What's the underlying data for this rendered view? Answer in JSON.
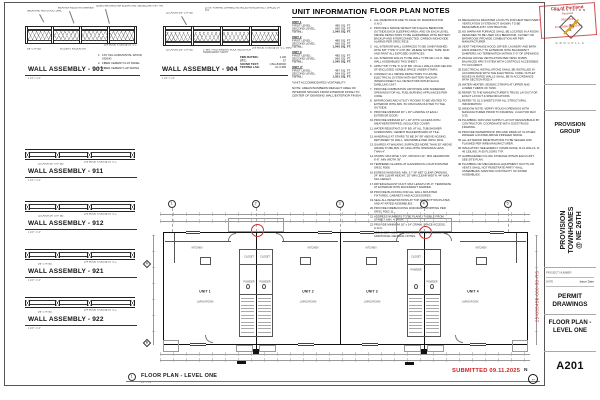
{
  "sheet": {
    "submitted_stamp": "SUBMITTED 09.11.2025",
    "permit_number_vertical": "25-035456-000-00-RS",
    "north_label": "N",
    "north_arrow": "←",
    "view_title": {
      "number": "1",
      "title": "FLOOR PLAN - LEVEL ONE",
      "scale": "1/4\" = 1'-0\""
    }
  },
  "title_block": {
    "logo_brand": "P R O V I S I O N",
    "logo_letter": "P",
    "logo_sub": "G R O U P  L L C",
    "stamp": {
      "city": "City of Portland",
      "line2": "Received",
      "line3": "09/11/2025",
      "line4": "25-035456-000-00-RS"
    },
    "firm_name": "PROVISION GROUP",
    "project_name_line1": "PROVISION TOWNHOMES",
    "project_name_line2": "@ NE 26TH",
    "fields": [
      {
        "label": "PROJECT NUMBER",
        "value": "2025001"
      },
      {
        "label": "DATE",
        "value": "Issue Date"
      }
    ],
    "phase": "PERMIT DRAWINGS",
    "sheet_title_line1": "FLOOR PLAN -",
    "sheet_title_line2": "LEVEL ONE",
    "sheet_number": "A201"
  },
  "wall_assemblies": [
    {
      "title": "WALL ASSEMBLY - 901",
      "scale": "1 1/2\" = 1'-0\"",
      "callout_top_1": "SHEATHING PER STRUCTURAL",
      "callout_top_2": "WEATHER RESISTANT BARRIER",
      "callout_top_3": "SIDING MATERIAL PER ELEVATIONS, SEE BELOW FOR TYPE",
      "callout_bot_1": "5/8\" GYP. BD.",
      "callout_bot_2": "R-21 BATT INSULATION",
      "callout_bot_3": "2X6 WOOD STUDS @ 16\" O.C.",
      "siding_types": [
        "1X6 T&G HORIZONTAL WOOD SIDING",
        "FIBER CEMENT FLAT PANEL",
        "FIBER CEMENT LAP SIDING"
      ]
    },
    {
      "title": "WALL ASSEMBLY - 904",
      "scale": "1 1/2\" = 1'-0\"",
      "callout_top_1": "(2) LAYERS 5/8\" GYP. BD.",
      "callout_top_2": "25 GA. FURRING CHANNEL INSTALLED HORIZONTALLY, SPACED 24\" O.C.",
      "callout_bot_1": "(2) LAYERS 5/8\" GYP. BD.",
      "callout_bot_2": "3\" MIN. THICK MINERAL WOOL INSULATION THROUGHOUT CAVITY",
      "callout_bot_3": "2X6 WOOD STUDS @ 16\" O.C. (MIN)",
      "ratings": [
        {
          "label": "FIRE RATING:",
          "value": "1 HR"
        },
        {
          "label": "STC:",
          "value": "57"
        },
        {
          "label": "SOUND TEST:",
          "value": "USG-840630"
        },
        {
          "label": "TESTING LAB:",
          "value": "UL U305"
        }
      ]
    },
    {
      "title": "WALL ASSEMBLY - 911",
      "scale": "1 1/2\" = 1'-0\"",
      "callout_bot_1": "(1) LAYER 5/8\" GYP. BD.",
      "callout_bot_2": "2X6 WOOD STUDS @ 16\" O.C."
    },
    {
      "title": "WALL ASSEMBLY - 912",
      "scale": "1 1/2\" = 1'-0\"",
      "callout_bot_1": "(1) LAYER 5/8\" GYP. BD.",
      "callout_bot_2": "2X6 WOOD STUDS @ 16\" O.C."
    },
    {
      "title": "WALL ASSEMBLY - 921",
      "scale": "1 1/2\" = 1'-0\"",
      "callout_bot_1": "5/8\" GYP. BD.",
      "callout_bot_2": "2X4 WOOD STUDS @ 16\" O.C."
    },
    {
      "title": "WALL ASSEMBLY - 922",
      "scale": "1 1/2\" = 1'-0\"",
      "callout_bot_1": "5/8\" GYP. BD.",
      "callout_bot_2": "2X4 WOOD STUDS @ 16\" O.C."
    }
  ],
  "unit_information": {
    "heading": "UNIT INFORMATION",
    "row_labels": {
      "first": "FIRST LEVEL:",
      "second": "SECOND LEVEL:",
      "total": "TOTAL:"
    },
    "units": [
      {
        "name": "UNIT 1",
        "first": "485 SQ. FT.",
        "second": "560 SQ. FT.",
        "total": "1,045 SQ. FT."
      },
      {
        "name": "UNIT 2",
        "first": "485 SQ. FT.",
        "second": "560 SQ. FT.",
        "total": "1,045 SQ. FT."
      },
      {
        "name": "UNIT 3",
        "first": "485 SQ. FT.",
        "second": "560 SQ. FT.",
        "total": "1,045 SQ. FT."
      },
      {
        "name": "UNIT 4*",
        "first": "487 SQ. FT.",
        "second": "564 SQ. FT.",
        "total": "1,051 SQ. FT."
      }
    ],
    "footnote": "*UNIT ACCOMMODATES VISITABILITY",
    "note": "NOTE: AREAS/NUMBERS REFLECT AREA OF INTERIOR SPACES FROM INTERIOR FINISH TO CENTER OF DEMISING WALL/EXTERIOR FINISH."
  },
  "floor_plan_notes": {
    "heading": "FLOOR PLAN NOTES",
    "notes_col1": [
      "ALL DIMENSIONS ARE TO FACE OF FRAMING/STUD U.N.O.",
      "PROVIDE A SMOKE DETECTOR IN EACH BEDROOM, OUTSIDE EACH SLEEPING AREA, AND ON EACH LEVEL. SMOKE DETECTORS TO BE HARDWIRED WITH BATTERY BACKUP AND INTERCONNECTED. CARBON MONOXIDE ALARMS PER ORSC R315.",
      "ALL INTERIOR WALL SURFACES TO BE GWB FINISHED WITH 5/8\" TYPE 'X' GYP. BD. WHERE NOTED. TAPE, MUD AND PAINT ALL EXPOSED SURFACES.",
      "ALL INTERIOR WALLS TO BE WALL TYPE 911 U.N.O. SEE WALL ASSEMBLIES THIS SHEET.",
      "APPLY 5/8\" TYPE 'X' GYP. BD. ON ALL WALLS AND CEILING OF ENCLOSED USABLE SPACE UNDER STAIRS.",
      "CONNECT ALL SMOKE DETECTORS TO HOUSE ELECTRICAL SYSTEM WITH BATTERY BACKUP; INTERCONNECT ALL DETECTORS WITHIN EACH DWELLING UNIT.",
      "PROVIDE COMBUSTION AIR INTAKE AND SCREENED OPENINGS FOR ALL FUEL BURNING APPLIANCES PER CODE.",
      "BATHROOMS AND UTILITY ROOMS TO BE VENTED TO EXTERIOR WITH MIN. 50 CFM FANS DUCTED TO THE OUTSIDE.",
      "PROVIDE MINIMUM 36\" x 36\" LANDING AT EACH EXTERIOR DOOR.",
      "PROVIDE MINIMUM 22\" x 30\" ATTIC ACCESS WITH WEATHERSTRIPPED, INSULATED COVER.",
      "WATER RESISTANT GYP. BD. AT ALL TUB/SHOWER SURROUNDS; CEMENT BACKER BOARD AT TILE.",
      "HANDRAILS AT STAIRS TO BE 34\"-38\" ABOVE NOSING, RETURNED TO WALL, GRASPABLE PER ORSC R311.",
      "GUARDS AT WALKING SURFACES MORE THAN 30\" ABOVE GRADE TO BE MIN. 36\" HIGH WITH OPENINGS LESS THAN 4\".",
      "STAIRS: MAX RISE 7-3/4\", MIN RUN 10\", MIN HEADROOM 6'-8\", MIN WIDTH 36\".",
      "TEMPERED GLAZING AT HAZARDOUS LOCATIONS PER ORSC R308.",
      "EGRESS WINDOWS: MIN. 5.7 SF NET CLEAR OPENING, 24\" MIN CLEAR HEIGHT, 20\" MIN CLEAR WIDTH, 44\" MAX SILL HEIGHT.",
      "DRYER EXHAUST DUCT: MAX LENGTH 35'-0\"; TERMINATE AT EXTERIOR WITH BACKDRAFT DAMPER.",
      "PROVIDE BLOCKING FOR ALL WALL MOUNTED FIXTURES, CABINETS AND ACCESSORIES.",
      "SEAL ALL PENETRATIONS AT TOP AND BOTTOM PLATES AND AT RATED ASSEMBLIES.",
      "PROVIDE FIREBLOCKING AND DRAFTSTOPPING PER ORSC R302.11.",
      "ADDRESS NUMBERS TO BE PLAINLY VISIBLE FROM STREET, MIN. 4\" HIGH.",
      "PROVIDE MINIMUM 18\" x 24\" CRAWL SPACE ACCESS, U.N.O.",
      "SEE SHEET A001 FOR ABBREVIATIONS, SYMBOLS AND ADDITIONAL GENERAL NOTES."
    ],
    "notes_col2": [
      "MECHANICAL REGISTER LAYOUTS FOR HEAT RECOVERY VENTILATION SYSTEM NOT SHOWN; TO BE DESIGN/BUILD BY CONTRACTOR.",
      "NO WARM AIR FURNACE SHALL BE LOCATED IN A ROOM DESIGNED TO BE USED AS A BEDROOM, CLOSET OR BATHROOM; PROVIDE COMBUSTION AIR PER MANUFACTURER.",
      "VENT THE RANGE HOOD, DRYER, LAUNDRY AND BATH FANS DIRECTLY TO EXTERIOR WITH BACKDRAFT DAMPERS; NO TERMINATION WITHIN 3'-0\" OF OPENINGS.",
      "WHOLE HOUSE VENTILATION PER ORSC M1505; BALANCED HRV SYSTEM WITH CONTROLS ACCESSIBLE TO OCCUPANT.",
      "ELECTRICAL INSTALLATIONS SHALL BE INSTALLED IN ACCORDANCE WITH THE ELECTRICAL CODE; OUTLET BOXES IN RATED WALLS SHALL BE IN ACCORDANCE WITH SECTION R302.4.",
      "WATER HEATER: SEISMIC STRAPS AT UPPER AND LOWER THIRDS OF TANK.",
      "REFER TO THE MANUFACTURER'S TRUSS LAYOUT FOR EXACT LAYOUT & SPECIFICATIONS.",
      "REFER TO S1.0 SHEETS FOR ALL STRUCTURAL INFORMATION.",
      "WINDOW NOTE: VERIFY ROUGH OPENINGS WITH MANUFACTURER PRIOR TO FRAMING; U-FACTOR MAX 0.30.",
      "PLUMBING: DWV AND SUPPLY LAYOUT DESIGN/BUILD BY CONTRACTOR; COORDINATE WITH JOIST/TRUSS FRAMING.",
      "PROVIDE WATERPROOF PAN AND DRAIN AT CLOTHES WASHER LOCATED ABOVE FINISHED SPACE.",
      "ALL EXTERIOR PENETRATIONS TO BE SEALED AND FLASHED PER WRB MANUFACTURER.",
      "INSULATION: SEE ENERGY COMPLIANCE; R-21 WALLS, R-49 CEILING, R-30 FLOORS TYP.",
      "GARBAGE/RECYCLING STORAGE WITHIN EACH UNIT; SEE SITE PLAN.",
      "PLUMBING OR MECHANICAL EQUIPMENT, DUCTS OR VENTS SHALL NOT PENETRATE PARTY WALL ASSEMBLIES; MAINTAIN CONTINUITY OF RATED ASSEMBLIES."
    ]
  },
  "floor_plan": {
    "grid_columns": [
      "1",
      "2",
      "3",
      "4",
      "5"
    ],
    "grid_rows": [
      "A",
      "B"
    ],
    "labels": {
      "kitchen": "KITCHEN",
      "living": "LIVING ROOM",
      "closet": "CLOSET",
      "powder": "POWDER"
    },
    "units": [
      "UNIT 1",
      "UNIT 2",
      "UNIT 3",
      "UNIT 4"
    ]
  }
}
